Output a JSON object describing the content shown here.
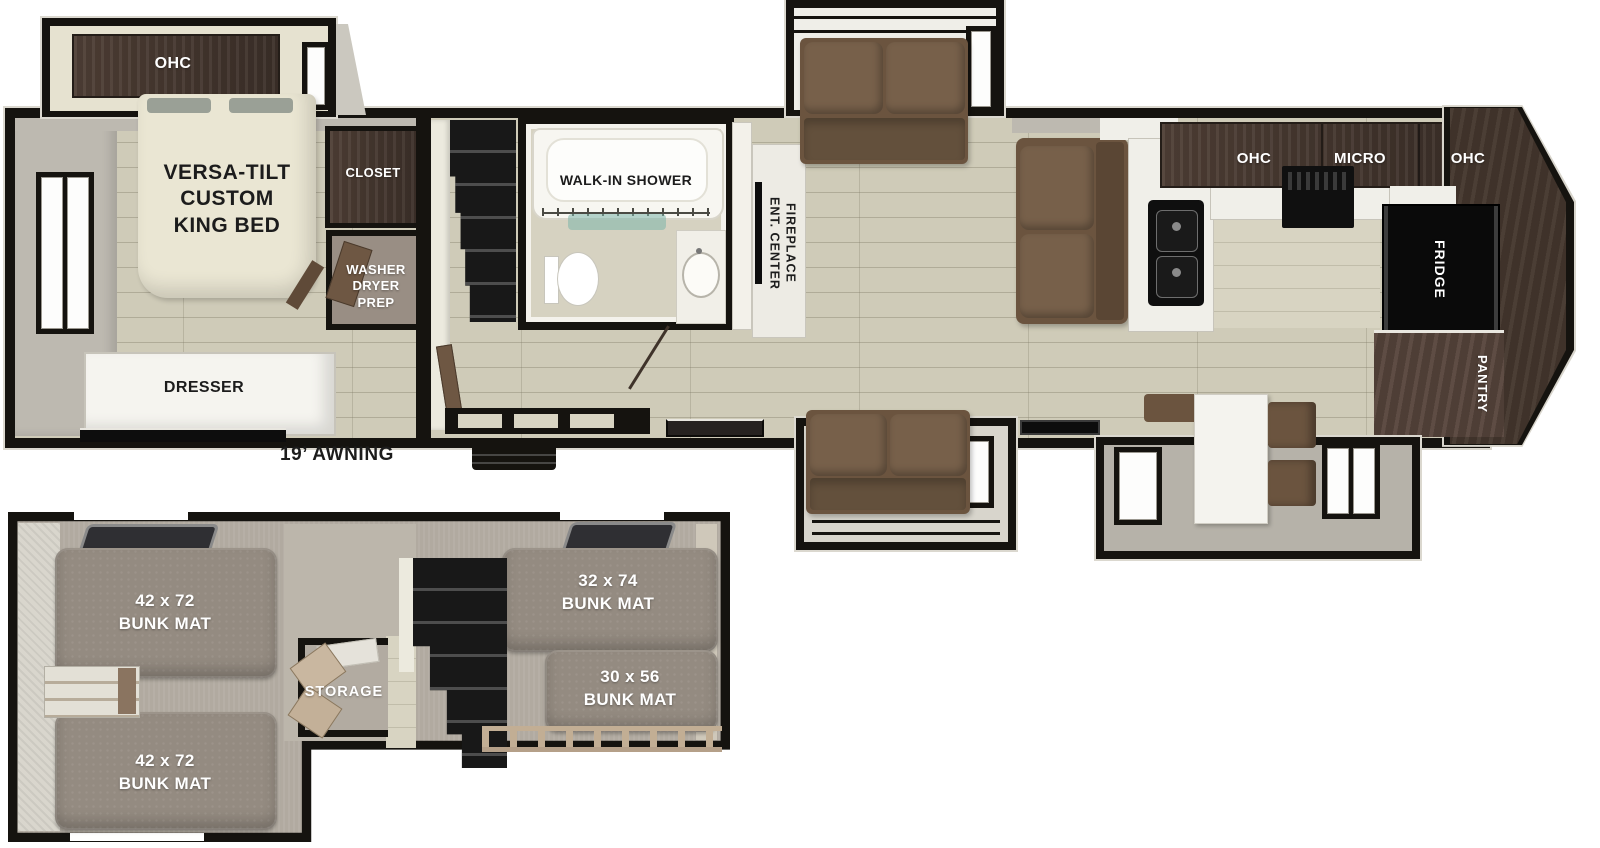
{
  "colors": {
    "wall": "#15130f",
    "floor_wood": "#cfcbb8",
    "cabinet_brown": "#473931",
    "sofa_brown": "#6b543f",
    "bed_cream": "#eae6d3",
    "loft_carpet": "#b1aaa0",
    "bunk_mat": "#948b81"
  },
  "main_floor": {
    "bedroom": {
      "ohc": "OHC",
      "bed": "VERSA-TILT\nCUSTOM\nKING BED",
      "closet": "CLOSET",
      "washer_dryer": "WASHER\nDRYER\nPREP",
      "dresser": "DRESSER"
    },
    "awning": "19’ AWNING",
    "bathroom": {
      "shower": "WALK-IN SHOWER"
    },
    "living": {
      "ent_center": "ENT. CENTER\nFIREPLACE"
    },
    "kitchen": {
      "ohc_left": "OHC",
      "micro": "MICRO",
      "ohc_right": "OHC",
      "fridge": "FRIDGE",
      "pantry": "PANTRY"
    }
  },
  "loft": {
    "bunk_upper_left": "42 x 72\nBUNK MAT",
    "bunk_lower_left": "42 x 72\nBUNK MAT",
    "bunk_upper_right": "32 x 74\nBUNK MAT",
    "bunk_lower_right": "30 x 56\nBUNK MAT",
    "storage": "STORAGE"
  }
}
